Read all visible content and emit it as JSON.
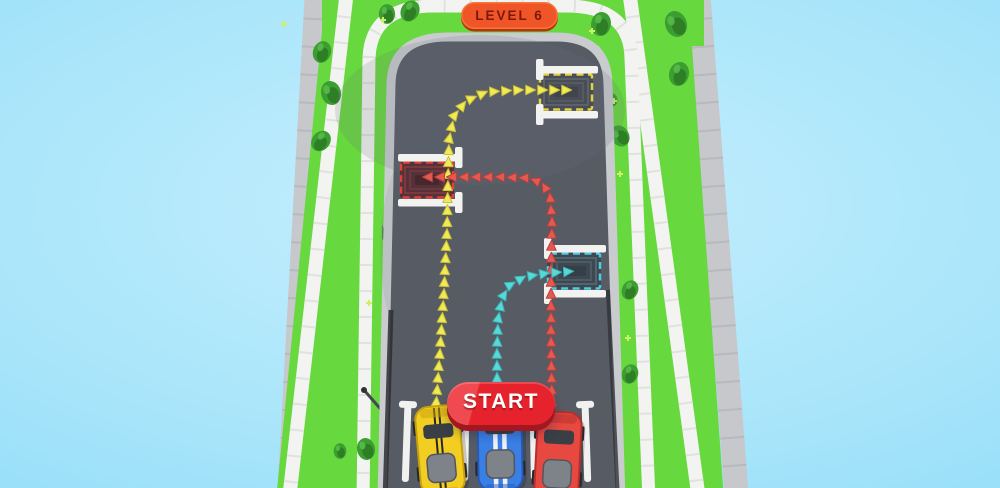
{
  "hud": {
    "level_badge": {
      "label": "LEVEL 6",
      "bg": "#ef5526",
      "text_color": "#7b190e",
      "shadow": "#b5330f"
    },
    "start_button": {
      "label": "START",
      "bg": "#e6232c",
      "bg_highlight": "#ef4a50",
      "shadow": "#a21720",
      "text_color": "#ffffff"
    }
  },
  "scene": {
    "colors": {
      "sky_center": "#c6effd",
      "sky_edge": "#7bd6f7",
      "road": "#565b64",
      "curb": "#c9cbce",
      "grass": "#67d83e",
      "walk_path": "#f3f4f1",
      "sidewalk": "#c6c8cb",
      "marking_white": "#f2f3f1"
    },
    "cars": [
      {
        "id": "yellow-car",
        "x": 440,
        "y": 450,
        "angle": -5,
        "color": "#f2cd22",
        "dark": "#c7a10c",
        "stripes": {
          "color": "#24282d",
          "width": 2,
          "offset": 2.5
        }
      },
      {
        "id": "blue-car",
        "x": 500,
        "y": 446,
        "angle": -1,
        "color": "#3a7fe6",
        "dark": "#2759b8",
        "stripes": {
          "color": "#eef3f8",
          "width": 4.5,
          "offset": 4.5
        }
      },
      {
        "id": "red-car",
        "x": 558,
        "y": 456,
        "angle": 3,
        "color": "#e74840",
        "dark": "#b52f2c",
        "stripes": null
      }
    ],
    "routes": [
      {
        "id": "yellow-route",
        "color": "#f0ea54",
        "edge": "#c9bd37",
        "points": [
          [
            436,
            406
          ],
          [
            440,
            350
          ],
          [
            444,
            290
          ],
          [
            447,
            230
          ],
          [
            448,
            175
          ],
          [
            449,
            140
          ],
          [
            454,
            116
          ],
          [
            466,
            101
          ],
          [
            486,
            92
          ],
          [
            520,
            90
          ],
          [
            568,
            90
          ]
        ]
      },
      {
        "id": "red-route",
        "color": "#e45a52",
        "edge": "#bb3f3a",
        "points": [
          [
            552,
            406
          ],
          [
            551,
            340
          ],
          [
            551,
            270
          ],
          [
            552,
            220
          ],
          [
            550,
            196
          ],
          [
            543,
            184
          ],
          [
            529,
            178
          ],
          [
            500,
            177
          ],
          [
            460,
            177
          ],
          [
            421,
            177
          ]
        ]
      },
      {
        "id": "blue-route",
        "color": "#59d8d8",
        "edge": "#3bb3b6",
        "points": [
          [
            497,
            406
          ],
          [
            497,
            350
          ],
          [
            498,
            320
          ],
          [
            502,
            298
          ],
          [
            510,
            285
          ],
          [
            524,
            277
          ],
          [
            548,
            273
          ],
          [
            577,
            271
          ]
        ]
      }
    ],
    "parking_spots": [
      {
        "id": "yellow-parking-spot",
        "color": "#e6d23e",
        "entry": "left",
        "cx": 566,
        "cy": 92,
        "pad": "#494d55",
        "pad_line": "#5d616a",
        "pad_core": "#40444c"
      },
      {
        "id": "red-parking-spot",
        "color": "#e04138",
        "entry": "right",
        "cx": 427,
        "cy": 180,
        "pad": "#55323a",
        "pad_line": "#7a393c",
        "pad_core": "#47272e"
      },
      {
        "id": "blue-parking-spot",
        "color": "#4ecbe4",
        "entry": "left",
        "cx": 574,
        "cy": 271,
        "pad": "#3e4851",
        "pad_line": "#53646f",
        "pad_core": "#353f48"
      }
    ],
    "lane_dividers": [
      {
        "x": 408,
        "y": 403,
        "rot": 2
      },
      {
        "x": 466,
        "y": 402,
        "rot": 1
      },
      {
        "x": 533,
        "y": 401,
        "rot": -1
      },
      {
        "x": 585,
        "y": 403,
        "rot": -2
      }
    ],
    "trees": [
      {
        "x": 322,
        "y": 52,
        "s": 1.0,
        "r": 20
      },
      {
        "x": 331,
        "y": 93,
        "s": 1.1,
        "r": -15
      },
      {
        "x": 321,
        "y": 141,
        "s": 1.0,
        "r": 40
      },
      {
        "x": 387,
        "y": 14,
        "s": 0.9,
        "r": 0
      },
      {
        "x": 410,
        "y": 11,
        "s": 1.0,
        "r": 30
      },
      {
        "x": 601,
        "y": 24,
        "s": 1.1,
        "r": 10
      },
      {
        "x": 676,
        "y": 24,
        "s": 1.2,
        "r": -20
      },
      {
        "x": 679,
        "y": 74,
        "s": 1.1,
        "r": 15
      },
      {
        "x": 620,
        "y": 136,
        "s": 1.0,
        "r": -30
      },
      {
        "x": 612,
        "y": 100,
        "s": 0.6,
        "r": 0
      },
      {
        "x": 630,
        "y": 290,
        "s": 0.9,
        "r": 25
      },
      {
        "x": 630,
        "y": 374,
        "s": 0.9,
        "r": 20
      },
      {
        "x": 366,
        "y": 449,
        "s": 1.0,
        "r": -10
      },
      {
        "x": 340,
        "y": 451,
        "s": 0.7,
        "r": 0
      }
    ],
    "sparkles": [
      [
        383,
        20
      ],
      [
        492,
        22
      ],
      [
        592,
        31
      ],
      [
        620,
        174
      ],
      [
        614,
        101
      ],
      [
        369,
        303
      ],
      [
        284,
        24
      ],
      [
        628,
        338
      ]
    ],
    "streetlight": {
      "x1": 364,
      "y1": 390,
      "x2": 384,
      "y2": 413
    },
    "roadside_box": {
      "x": 383,
      "y": 226
    }
  }
}
